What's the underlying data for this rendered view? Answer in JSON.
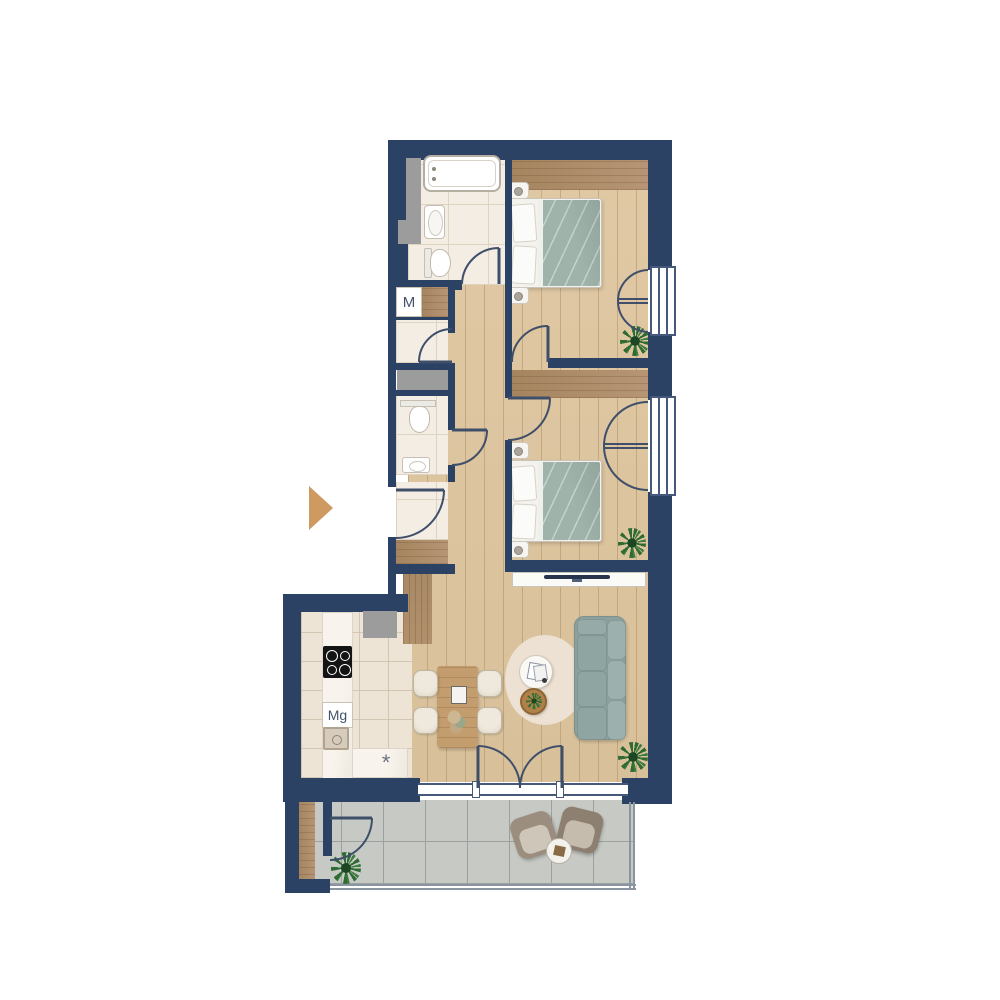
{
  "floor_plan": {
    "labels": {
      "utility_closet": "M",
      "kitchen_appliance": "Mg",
      "dishwasher_symbol": "*"
    },
    "colors": {
      "wall": "#2b4264",
      "tile-light": "#f3ede3",
      "tile-line": "#ded2c0",
      "kitchen-tile": "#ede4d6",
      "balcony-tile": "#c6c9c4",
      "balcony-tile-line": "#9ba1a0",
      "bed-textile": "#9fb3ab",
      "sofa": "#8ba19e",
      "rug": "#ece2d3",
      "shaft-gray": "#9c9c9c",
      "door-line": "#3f4f6a",
      "entrance-arrow": "#cf9a62",
      "plant-green": "#2f6b33",
      "marble": "#f7f3ec",
      "dining-wood": "#c49d6e",
      "balcony-chair": "#998b7c",
      "label-text": "#44536b"
    }
  }
}
